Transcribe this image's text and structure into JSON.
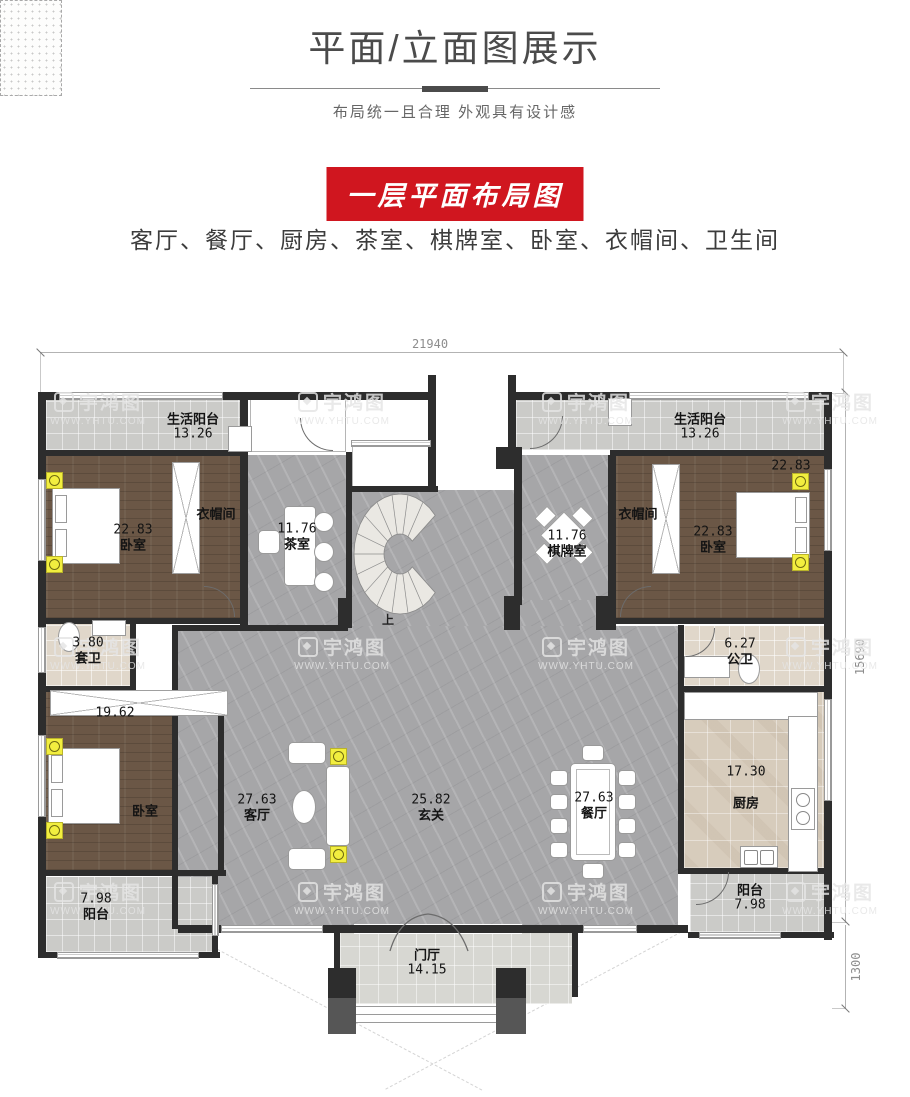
{
  "header": {
    "title": "平面/立面图展示",
    "subtitle": "布局统一且合理 外观具有设计感"
  },
  "section": {
    "banner": "一层平面布局图",
    "room_list": "客厅、餐厅、厨房、茶室、棋牌室、卧室、衣帽间、卫生间"
  },
  "plan": {
    "dims": {
      "top": "21940",
      "right": "15690",
      "corner": "1300"
    },
    "stairs_up": "上",
    "rooms": {
      "balcony_tl": {
        "name": "生活阳台",
        "area": "13.26"
      },
      "balcony_tr": {
        "name": "生活阳台",
        "area": "13.26"
      },
      "bedroom_tl": {
        "name": "卧室",
        "area": "22.83"
      },
      "cloak_l": {
        "name": "衣帽间"
      },
      "tea": {
        "name": "茶室",
        "area": "11.76"
      },
      "chess": {
        "name": "棋牌室",
        "area": "11.76"
      },
      "cloak_r": {
        "name": "衣帽间"
      },
      "bedroom_tr": {
        "name": "卧室",
        "area": "22.83",
        "corner_area": "22.83"
      },
      "ensuite": {
        "name": "套卫",
        "area": "3.80"
      },
      "public_bath": {
        "name": "公卫",
        "area": "6.27"
      },
      "bedroom_bl": {
        "name": "卧室",
        "area": "19.62"
      },
      "living": {
        "name": "客厅",
        "area": "27.63"
      },
      "foyer": {
        "name": "玄关",
        "area": "25.82"
      },
      "dining": {
        "name": "餐厅",
        "area": "27.63"
      },
      "kitchen": {
        "name": "厨房",
        "area": "17.30"
      },
      "balcony_bl": {
        "name": "阳台",
        "area": "7.98"
      },
      "balcony_br": {
        "name": "阳台",
        "area": "7.98"
      },
      "porch": {
        "name": "门厅",
        "area": "14.15"
      }
    }
  },
  "watermark": {
    "logo": "宇鸿图",
    "url": "WWW.YHTU.COM"
  },
  "colors": {
    "accent_red": "#d0161f",
    "wall": "#2d2d2d",
    "wood_floor": "#6b5746",
    "marble_floor": "#a6a6a8",
    "tile_beige": "#d7ccbc",
    "balcony_gray": "#cbcbc8",
    "highlight_yellow": "#f2ee3f"
  }
}
